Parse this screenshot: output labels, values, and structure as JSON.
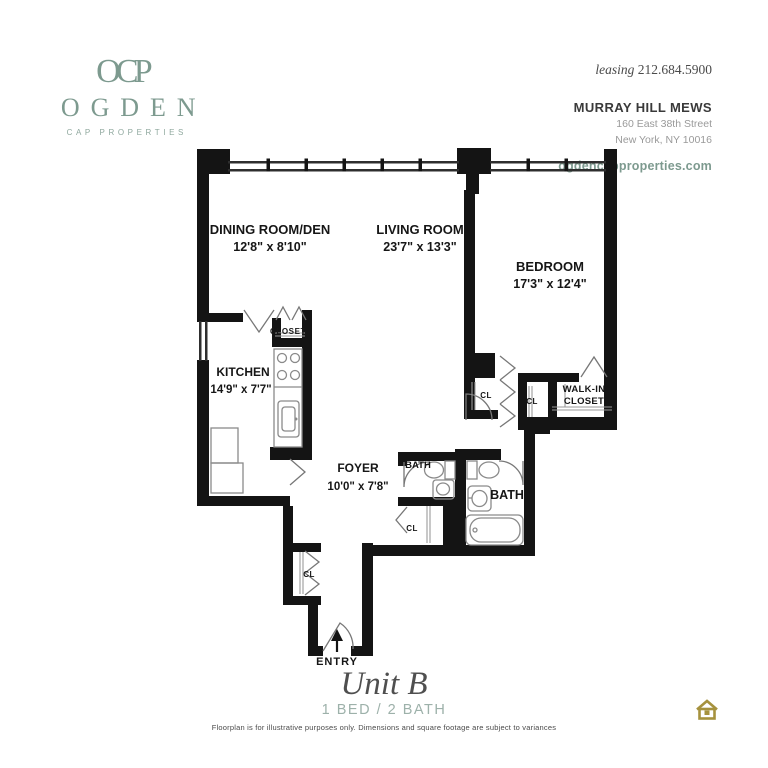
{
  "brand": {
    "monogram": "OCP",
    "name": "OGDEN",
    "tagline": "CAP PROPERTIES"
  },
  "contact": {
    "leasing_label": "leasing",
    "phone": "212.684.5900",
    "building": "MURRAY HILL MEWS",
    "address_line1": "160 East 38th Street",
    "address_line2": "New York, NY 10016",
    "website": "ogdencapproperties.com"
  },
  "floorplan": {
    "rooms": [
      {
        "name": "DINING ROOM/DEN",
        "dims": "12'8\" x 8'10\""
      },
      {
        "name": "LIVING ROOM",
        "dims": "23'7\" x 13'3\""
      },
      {
        "name": "BEDROOM",
        "dims": "17'3\" x 12'4\""
      },
      {
        "name": "KITCHEN",
        "dims": "14'9\" x 7'7\""
      },
      {
        "name": "FOYER",
        "dims": "10'0\" x 7'8\""
      }
    ],
    "labels": {
      "closet": "CLOSET",
      "walk_in_line1": "WALK-IN",
      "walk_in_line2": "CLOSET",
      "cl": "CL",
      "bath": "BATH",
      "entry": "ENTRY"
    }
  },
  "footer": {
    "unit_name": "Unit B",
    "unit_config": "1 BED / 2 BATH",
    "disclaimer": "Floorplan is for illustrative purposes only. Dimensions and square footage are subject to variances"
  },
  "colors": {
    "brand_green": "#7d9a8f",
    "wall_black": "#141414",
    "fixture_gray": "#8a8a8a",
    "housing_gold": "#a6923e"
  }
}
